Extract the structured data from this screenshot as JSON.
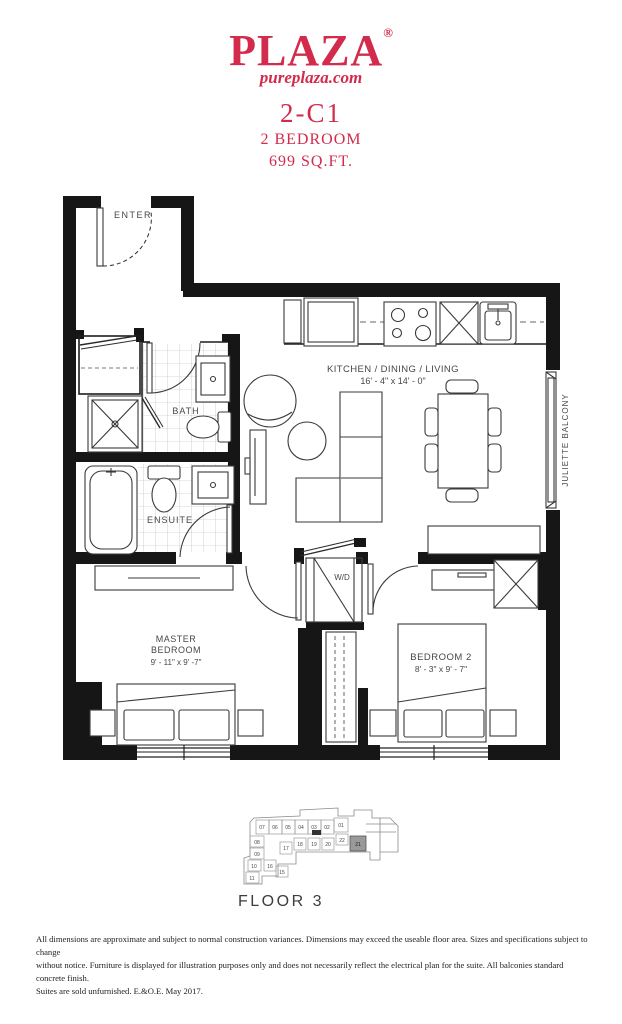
{
  "page": {
    "background": "#ffffff"
  },
  "header": {
    "brand": "PLAZA",
    "registered": "®",
    "website": "pureplaza.com",
    "unit_code": "2-C1",
    "unit_type": "2 BEDROOM",
    "area": "699 SQ.FT.",
    "accent_color": "#d22b4c"
  },
  "floor_plan": {
    "labels": {
      "enter": "ENTER",
      "bath": "BATH",
      "ensuite": "ENSUITE",
      "kitchen_title": "KITCHEN / DINING / LIVING",
      "kitchen_dims": "16' - 4\" x 14' - 0\"",
      "wd": "W/D",
      "juliette": "JULIETTE BALCONY",
      "master_line1": "MASTER",
      "master_line2": "BEDROOM",
      "master_dims": "9' - 11\" x 9' -7\"",
      "bedroom2": "BEDROOM 2",
      "bedroom2_dims": "8' - 3\" x 9' - 7\""
    }
  },
  "key_plan": {
    "floor_label": "FLOOR 3",
    "highlighted_unit": "21",
    "highlight_color": "#9a9a9a",
    "units": [
      "07",
      "06",
      "05",
      "04",
      "03",
      "02",
      "01",
      "22",
      "20",
      "19",
      "18",
      "17",
      "08",
      "09",
      "10",
      "11",
      "16",
      "15",
      "21"
    ]
  },
  "disclaimer_lines": [
    "All dimensions are approximate and subject to normal construction variances. Dimensions may exceed the useable floor area. Sizes and specifications subject to change",
    "without notice. Furniture is displayed for illustration purposes only and does not necessarily reflect the electrical plan for the suite. All balconies standard concrete finish.",
    "Suites are sold unfurnished. E.&O.E. May 2017."
  ]
}
